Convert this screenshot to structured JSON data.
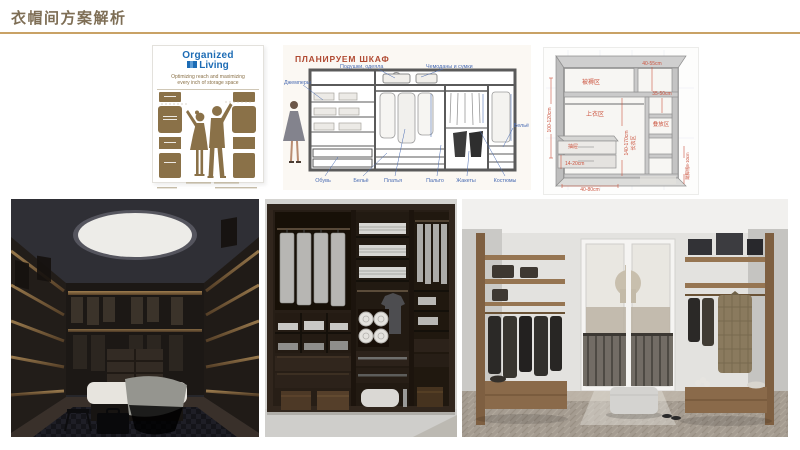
{
  "slide": {
    "title": "衣帽间方案解析"
  },
  "organized_living": {
    "brand_line1": "Organized",
    "brand_line2": "Living",
    "tagline_line1": "Optimizing reach and maximizing",
    "tagline_line2": "every inch of storage space"
  },
  "wardrobe_plan": {
    "title": "ПЛАНИРУЕМ ШКАФ",
    "label_pillows": "Подушки, одеяла",
    "label_suitcases": "Чемоданы и сумки",
    "label_sweaters": "Джемперы",
    "label_linen_right": "Бельё",
    "label_shoes": "Обувь",
    "label_linen": "Бельё",
    "label_dresses": "Платья",
    "label_coats": "Пальто",
    "label_jackets": "Жакеты",
    "label_suits": "Костюмы"
  },
  "dimensions_diagram": {
    "label_bedding_zone": "被褥区",
    "dim_top_height": "40-55cm",
    "dim_shelf_height": "35-50cm",
    "label_tops_zone": "上衣区",
    "label_stack_zone": "叠放区",
    "dim_left_height": "100-120cm",
    "dim_long_height": "140-170cm",
    "label_long_zone": "长衣区",
    "label_drawer": "抽屉",
    "dim_drawer_height": "14-20cm",
    "dim_bottom_width": "40-80cm",
    "dim_base_height": "踢脚线8-10cm"
  },
  "photos": {
    "left_alt": "dark-walk-in-closet-with-round-skylight",
    "middle_alt": "dark-brown-open-wardrobe-system",
    "right_alt": "bright-walk-in-closet-with-balcony-window"
  },
  "colors": {
    "title_brown": "#7e6e55",
    "underline_gold": "#c9a265",
    "logo_blue": "#1d6cb5",
    "silhouette_brown": "#8a7148",
    "plan_title_red": "#b04a32",
    "plan_label_blue": "#4a6cb3",
    "dim_red": "#cc5540"
  }
}
